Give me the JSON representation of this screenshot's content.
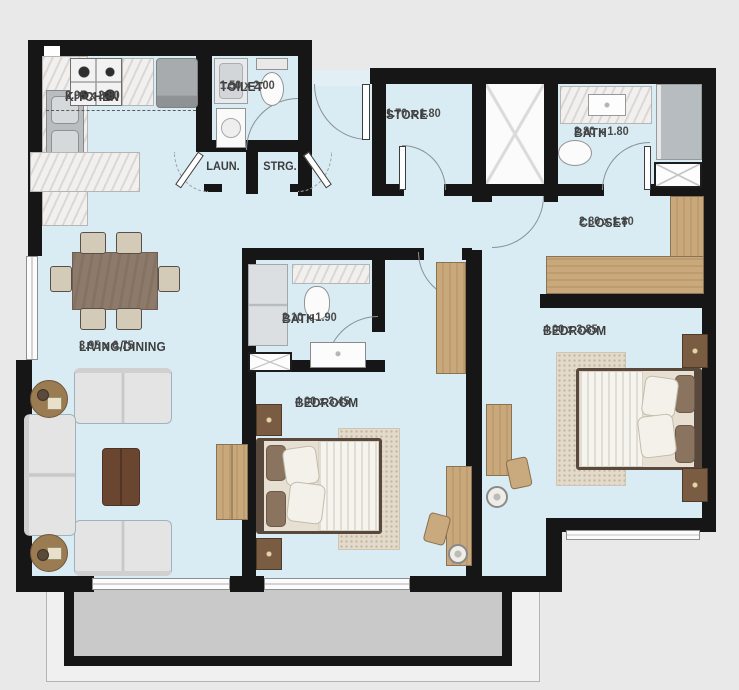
{
  "rooms": {
    "kitchen": {
      "name": "KITCHEN",
      "dims": "2.95 x 2.80"
    },
    "toilet": {
      "name": "TOILET",
      "dims": "1.50 x 2.00"
    },
    "laundry": {
      "name": "LAUN."
    },
    "storage": {
      "name": "STRG."
    },
    "store": {
      "name": "STORE",
      "dims": "1.70 x 1.80"
    },
    "bath_top": {
      "name": "BATH",
      "dims": "2.80 x 1.80"
    },
    "closet": {
      "name": "CLOSET",
      "dims": "2.80 x 1.80"
    },
    "living_dining": {
      "name": "LIVING/DINING",
      "dims": "3.95 x 6.75"
    },
    "bath_mid": {
      "name": "BATH",
      "dims": "2.10 x 1.90"
    },
    "bedroom_mid": {
      "name": "BEDROOM",
      "dims": "4.00 x 3.45"
    },
    "bedroom_right": {
      "name": "BEDROOM",
      "dims": "4.00 x 3.85"
    }
  },
  "colors": {
    "background": "#e9e9e9",
    "floor": "#d9ecf3",
    "wall": "#161616",
    "wood": "#c9a87c",
    "balcony_floor": "#c9c9c9",
    "label_text": "#3d3d3d"
  },
  "furniture_icons": [
    "dining-table",
    "dining-chair",
    "sofa",
    "loveseat",
    "coffee-table",
    "round-side-table",
    "tv-console",
    "bed",
    "nightstand",
    "wardrobe",
    "desk",
    "desk-chair",
    "stool",
    "stove",
    "fridge",
    "kitchen-sink",
    "kitchen-counter",
    "shower",
    "toilet-wc",
    "washbasin",
    "shower-tray",
    "rug",
    "balcony",
    "duct-shaft",
    "door-swing",
    "window"
  ]
}
